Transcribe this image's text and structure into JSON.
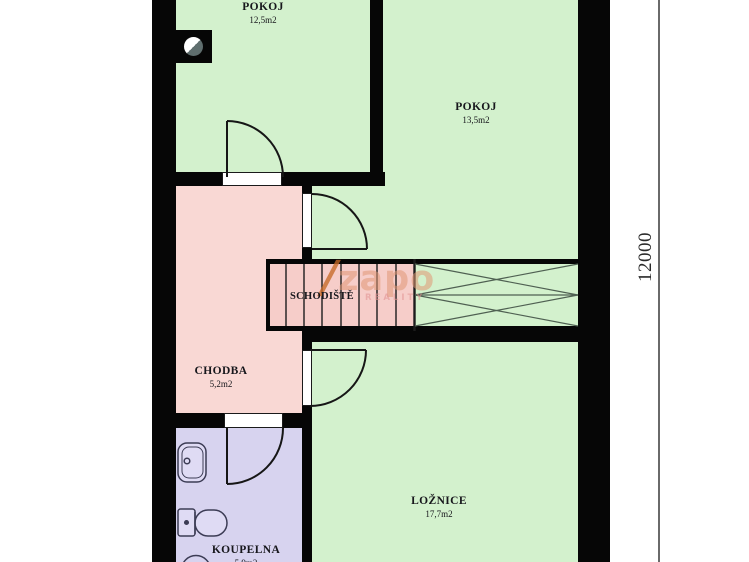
{
  "plan": {
    "title": "floor-plan",
    "rooms": [
      {
        "name": "POKOJ",
        "area": "12,5m2"
      },
      {
        "name": "POKOJ",
        "area": "13,5m2"
      },
      {
        "name": "CHODBA",
        "area": "5,2m2"
      },
      {
        "name": "SCHODIŠTĚ"
      },
      {
        "name": "LOŽNICE",
        "area": "17,7m2"
      },
      {
        "name": "KOUPELNA",
        "area": "5,9m2"
      }
    ],
    "dimension_label": "12000",
    "watermark": {
      "slash": "/",
      "brand": "zapo",
      "subtext": "REALITY"
    },
    "colors": {
      "room_green": "#d3f1cd",
      "hall_pink": "#f9d8d4",
      "stairs_pink": "#f6cdc9",
      "bathroom_lavender": "#d7d3ef",
      "wall_black": "#060606",
      "watermark_orange": "#de9475",
      "dimension_line_gray": "#6a6a6a"
    }
  }
}
